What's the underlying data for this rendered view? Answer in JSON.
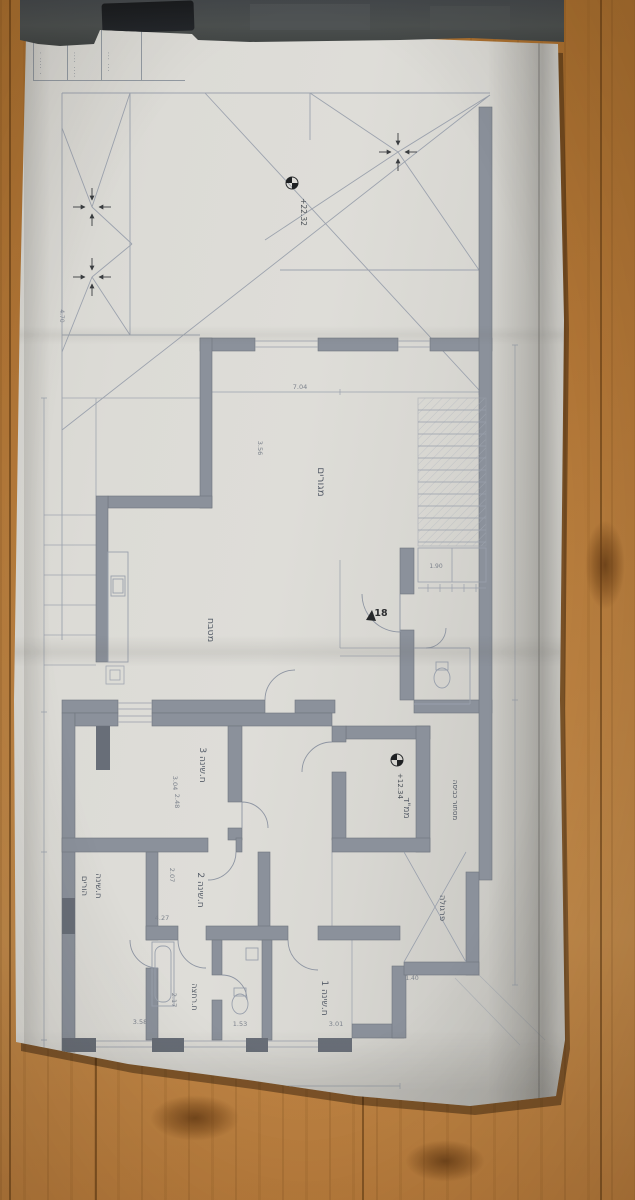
{
  "titleblock": {
    "col1": "· ···· ·",
    "col2": "···· ····",
    "col3": "··· ···"
  },
  "roof_plan": {
    "level_mark": "+22.32",
    "dim_left": "4.70"
  },
  "floor_plan": {
    "rooms": {
      "living": "מגורים",
      "kitchen": "מטבח",
      "safe_room": "ממ\"ד",
      "bedroom3": "ח.שינה 3",
      "bedroom2": "ח.שינה 2",
      "bedroom1": "ח.שינה 1",
      "master_line1": "ח.שינה",
      "master_line2": "הורים",
      "bathroom": "ח.רחצה",
      "pergola": "פרגולה",
      "laundry_screen": "מסתור כביסה"
    },
    "levels": {
      "safe_room": "+12.34"
    },
    "entry_door_tag": "18",
    "dimensions": {
      "living_width": "7.04",
      "living_height": "3.56",
      "bedroom3_a": "3.04",
      "bedroom3_b": "2.48",
      "bedroom2_width": "4.27",
      "bedroom2_height": "2.07",
      "bath_width": "2.17",
      "south_a": "3.58",
      "south_b": "1.53",
      "south_c": "3.01",
      "total_width": "12.68",
      "stair_cell": "1.90",
      "pergola_width": "1.40"
    }
  }
}
